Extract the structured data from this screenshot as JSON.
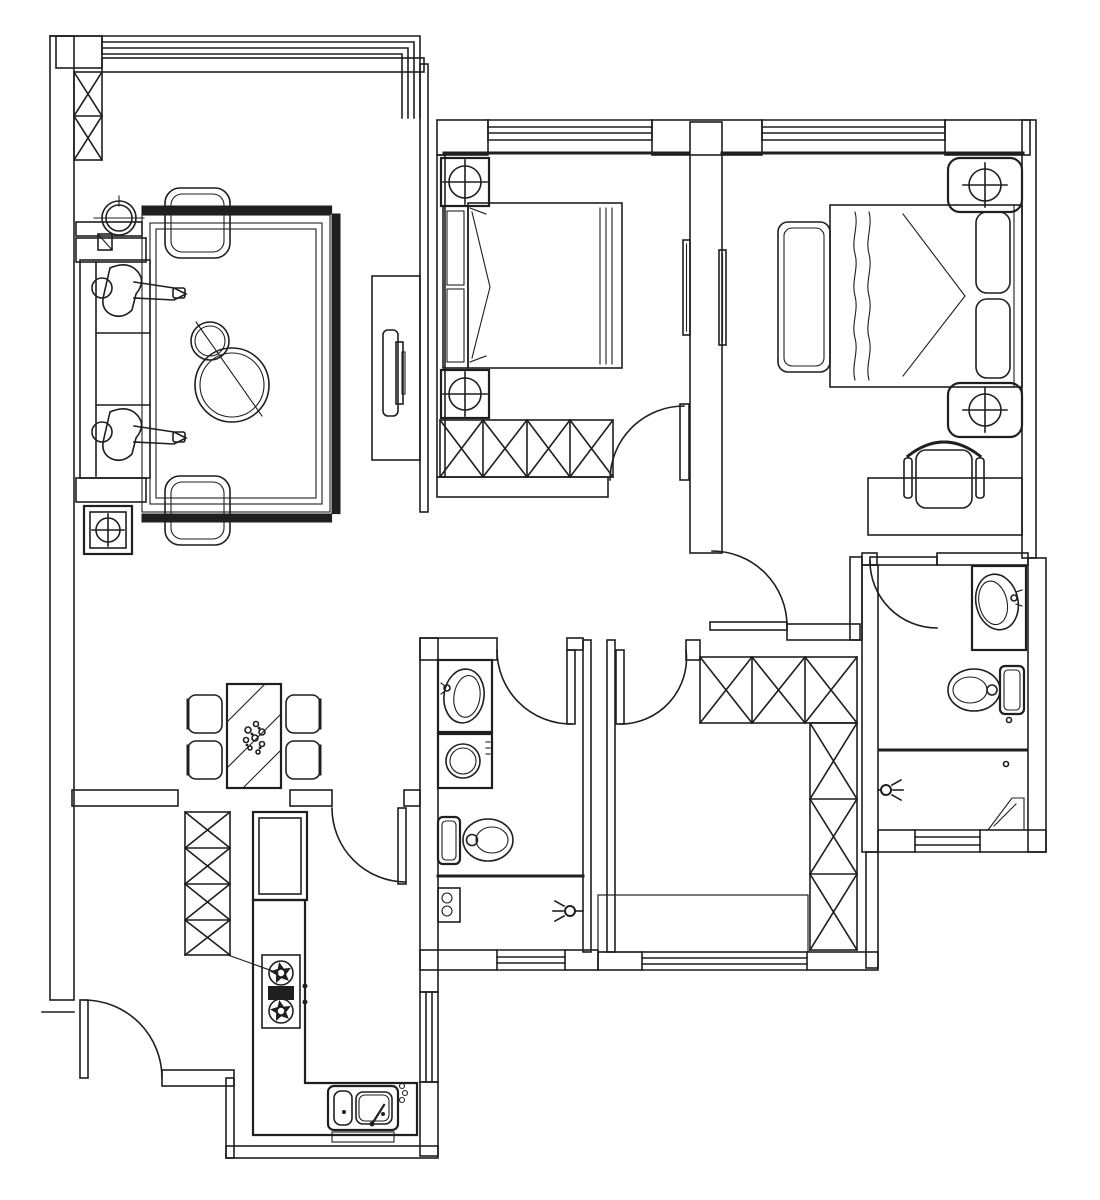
{
  "meta": {
    "app": "architectural-floor-plan",
    "description": "Black and white top-view floor plan drawing of a two-bedroom apartment; pure line work, no text labels visible",
    "canvas_width": 1100,
    "canvas_height": 1200,
    "colors": {
      "ink": "#1f1f1f",
      "paper": "#ffffff"
    }
  },
  "rooms": {
    "living_room": {
      "label": "Living room with balcony railing",
      "furniture": [
        "balcony railing",
        "hatched pillar cabinet",
        "three-seat sofa",
        "two seated figures",
        "side table",
        "square floor lamp",
        "potted plant",
        "two ottoman cushions",
        "fringed rug",
        "two round coffee tables",
        "TV cabinet with television"
      ]
    },
    "dining_area": {
      "label": "Dining area",
      "furniture": [
        "striped dining table with centerpiece",
        "four chairs"
      ]
    },
    "second_bedroom": {
      "label": "Second bedroom",
      "furniture": [
        "double bed with headboard pillows",
        "two nightstands with lamps",
        "four-section wardrobe",
        "top window",
        "swing door"
      ]
    },
    "master_bedroom": {
      "label": "Master bedroom",
      "furniture": [
        "double bed with two pillows and folded blanket",
        "two rounded nightstands with lamps",
        "bedside bench",
        "desk",
        "office chair",
        "top window",
        "swing door"
      ]
    },
    "ensuite_bathroom": {
      "label": "Bathroom",
      "furniture": [
        "vanity with oval basin",
        "toilet",
        "shower partition",
        "shower head",
        "floor drain",
        "corner tray",
        "bottom window",
        "swing door"
      ]
    },
    "hallway": {
      "label": "Hallway",
      "furniture": []
    },
    "small_bathroom": {
      "label": "Second bathroom",
      "furniture": [
        "vanity with oval basin",
        "washing machine",
        "toilet",
        "shower partition",
        "corner shelf",
        "shower head",
        "bottom window",
        "swing door"
      ]
    },
    "dressing_room": {
      "label": "Dressing / drying room",
      "furniture": [
        "L-shaped hatched wardrobe",
        "basket-weave tiled floor",
        "bottom window",
        "swing door"
      ]
    },
    "kitchen": {
      "label": "Kitchen",
      "furniture": [
        "tall hatched cabinet",
        "refrigerator cabinet",
        "L-shaped counter",
        "two-burner gas hob with grill",
        "double-bowl sink",
        "side window",
        "swing door"
      ]
    },
    "entry": {
      "label": "Entry hall",
      "furniture": [
        "entry swing door"
      ]
    }
  },
  "openings": {
    "doors": [
      "entry door",
      "kitchen door",
      "second bedroom door",
      "master bedroom door",
      "bathroom door",
      "second bathroom door",
      "dressing room door"
    ],
    "windows": [
      "second bedroom top window",
      "master bedroom top window",
      "bathroom bottom window",
      "dressing room bottom window",
      "second bathroom bottom window",
      "kitchen side window",
      "balcony railing lines"
    ]
  }
}
